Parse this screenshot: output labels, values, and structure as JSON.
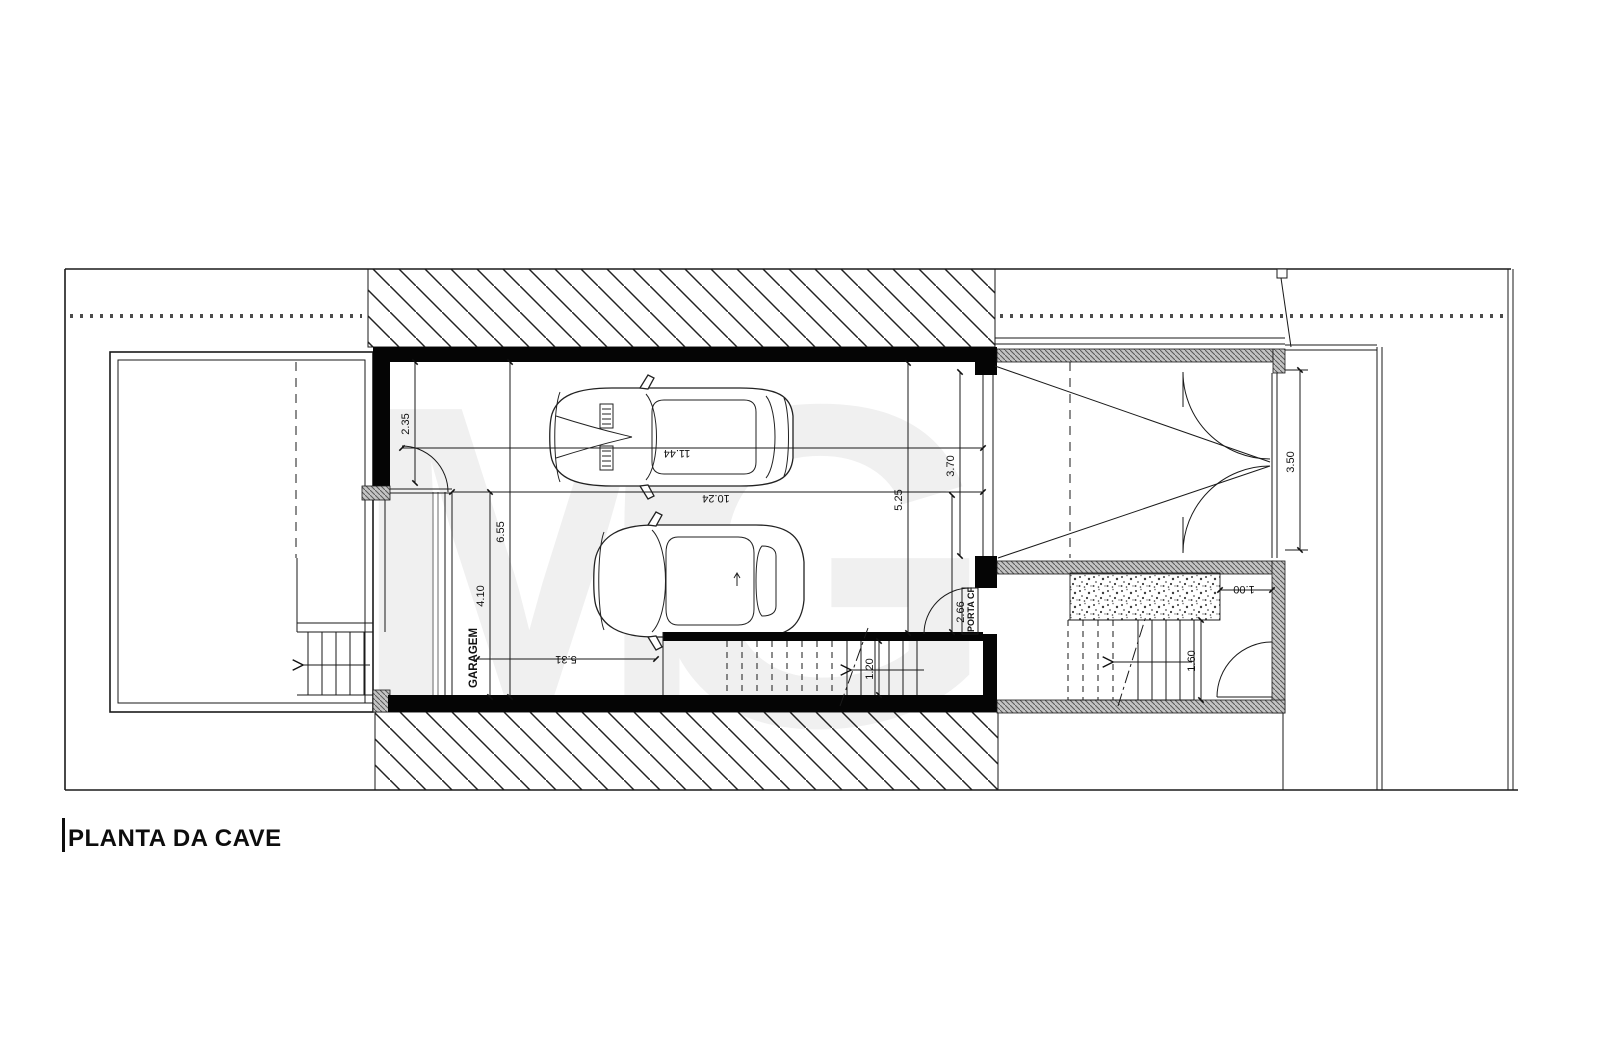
{
  "title": "PLANTA DA CAVE",
  "labels": {
    "garage": "GARAGEM",
    "fire_door": "PORTA CF"
  },
  "dimensions": {
    "recess": "2.35",
    "west_depth": "6.55",
    "lower_depth": "4.10",
    "bottom_width": "5.31",
    "overall_length": "11.44",
    "inner_length": "10.24",
    "gate_opening": "3.70",
    "east_depth": "5.25",
    "stair_recess": "2.66",
    "stair_width": "1.20",
    "entry_depth": "3.50",
    "planter_width": "1.00",
    "ext_stair_width": "1.60"
  },
  "watermark": {
    "left": "M",
    "right": "G"
  },
  "colors": {
    "line": "#1a1a1a",
    "wall": "#050505",
    "wall_hatch_bg": "#c4c4c4",
    "watermark": "#f0f0f0",
    "background": "#ffffff"
  }
}
